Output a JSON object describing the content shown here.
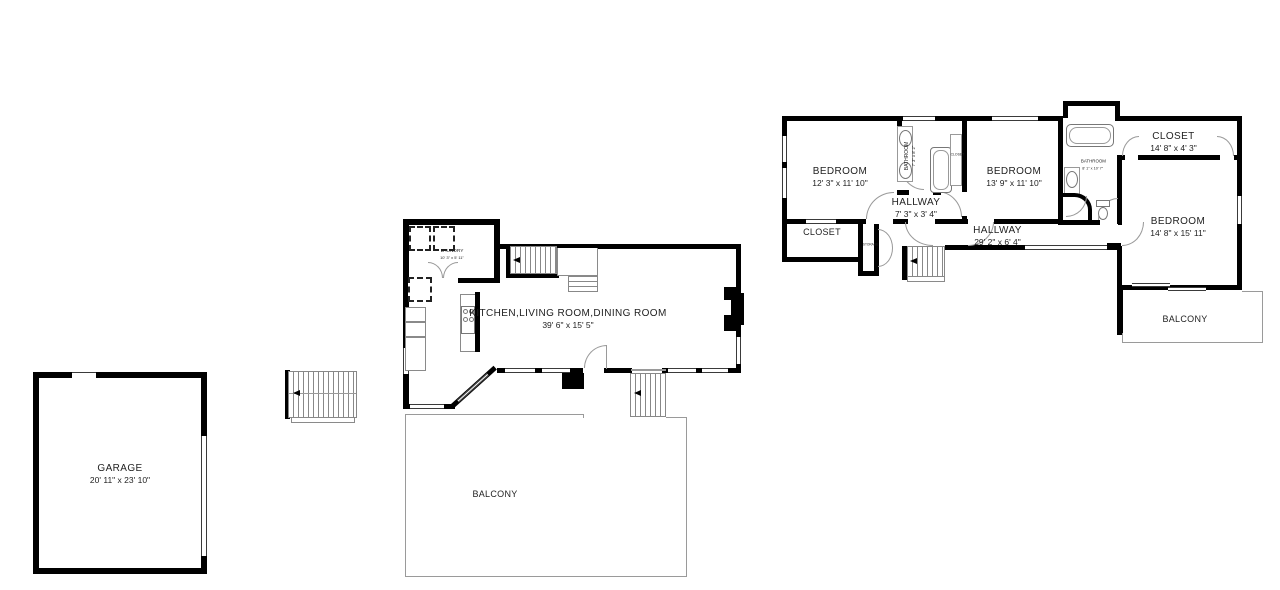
{
  "floorplan": {
    "garage": {
      "name": "GARAGE",
      "dims": "20' 11\" x 23' 10\""
    },
    "main": {
      "great_room_name": "KITCHEN,LIVING ROOM,DINING ROOM",
      "great_room_dims": "39' 6\" x 15' 5\"",
      "laundry_name": "LAUNDRY",
      "laundry_dims": "10' 3\" x 5' 11\"",
      "balcony": "BALCONY"
    },
    "upper": {
      "bedroom1_name": "BEDROOM",
      "bedroom1_dims": "12' 3\" x 11' 10\"",
      "bathroom1_name": "BATHROOM",
      "bathroom1_dims": "7' 3\" x 8' 2\"",
      "closet_nook": "CLOSET",
      "bedroom2_name": "BEDROOM",
      "bedroom2_dims": "13' 9\" x 11' 10\"",
      "bathroom2_name": "BATHROOM",
      "bathroom2_dims": "8' 1\" x 10' 7\"",
      "closet_top_name": "CLOSET",
      "closet_top_dims": "14' 8\" x 4' 3\"",
      "bedroom3_name": "BEDROOM",
      "bedroom3_dims": "14' 8\" x 15' 11\"",
      "hallway1_name": "HALLWAY",
      "hallway1_dims": "7' 3\" x 3' 4\"",
      "hallway2_name": "HALLWAY",
      "hallway2_dims": "29' 2\" x 6' 4\"",
      "closet_bl": "CLOSET",
      "storage": "STORAGE",
      "balcony": "BALCONY"
    }
  }
}
